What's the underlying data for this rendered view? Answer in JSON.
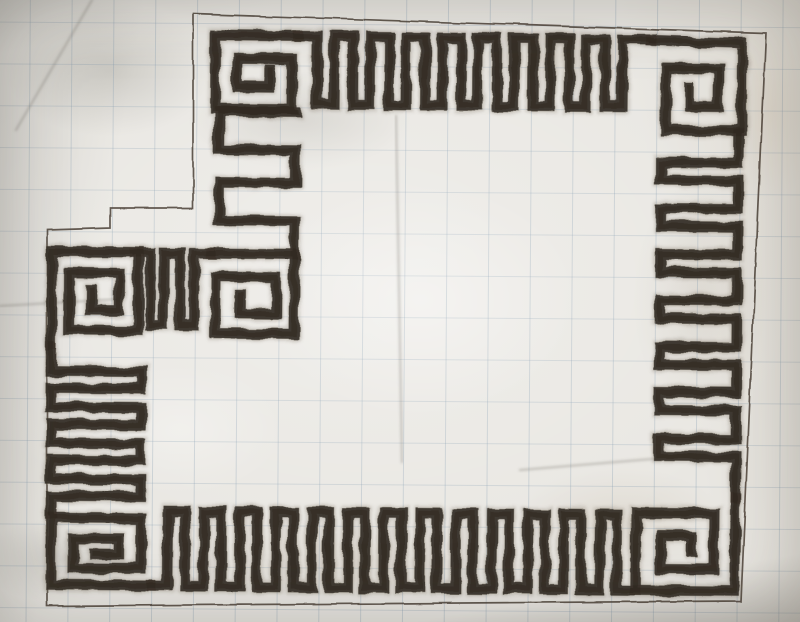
{
  "meta": {
    "description": "Hand-drawn Greek key meander border pattern sketched in dark charcoal pencil on wrinkled graph paper, inside a thin pencil outline with a stepped notch at the top-left; square spiral motifs at each corner."
  },
  "palette": {
    "paper": "#e9e7e2",
    "grid_line_v": "rgba(122,148,170,0.30)",
    "grid_line_h": "rgba(122,148,170,0.25)",
    "pencil_outline": "#4a4137",
    "charcoal_halo": "#77695a",
    "charcoal_main": "#3a332b",
    "charcoal_core": "#27211a",
    "crease": "rgba(110,106,98,0.35)"
  },
  "grid": {
    "cell": 41,
    "offset_x": 35,
    "offset_y": 30
  },
  "outline": {
    "width": 1.7,
    "points": [
      [
        193,
        14
      ],
      [
        766,
        33
      ],
      [
        741,
        601
      ],
      [
        47,
        606
      ],
      [
        47,
        230
      ],
      [
        110,
        228
      ],
      [
        110,
        208
      ],
      [
        193,
        208
      ]
    ],
    "closed": true
  },
  "pattern": {
    "rotation": "0.5 400 311",
    "halo_width": 14,
    "main_width": 10.5,
    "core_width": 5,
    "waves": [
      {
        "name": "meander-wave-top",
        "axis": "x",
        "dir": 1,
        "from": 296,
        "to": 648,
        "out": 37,
        "in": 105,
        "gap": 19,
        "tooth": 17
      },
      {
        "name": "meander-wave-right",
        "axis": "y",
        "dir": 1,
        "from": 132,
        "to": 494,
        "out": 737,
        "in": 660,
        "gap": 28,
        "tooth": 18
      },
      {
        "name": "meander-wave-bottom",
        "axis": "x",
        "dir": -1,
        "from": 638,
        "to": 154,
        "out": 588,
        "in": 513,
        "gap": 19,
        "tooth": 17
      },
      {
        "name": "meander-wave-left",
        "axis": "y",
        "dir": -1,
        "from": 518,
        "to": 350,
        "out": 52,
        "in": 142,
        "gap": 19,
        "tooth": 17
      },
      {
        "name": "meander-wave-notch",
        "axis": "x",
        "dir": 1,
        "from": 134,
        "to": 210,
        "out": 255,
        "in": 327,
        "gap": 16,
        "tooth": 14
      },
      {
        "name": "meander-wave-inner",
        "axis": "y",
        "dir": -1,
        "from": 255,
        "to": 112,
        "out": 294,
        "in": 218,
        "gap": 33,
        "tooth": 38
      }
    ],
    "spirals": [
      {
        "name": "corner-spiral-top-left",
        "points": [
          [
            296,
            37
          ],
          [
            213,
            37
          ],
          [
            213,
            110
          ],
          [
            290,
            110
          ],
          [
            290,
            60
          ],
          [
            235,
            60
          ],
          [
            235,
            88
          ],
          [
            268,
            88
          ],
          [
            268,
            71
          ]
        ]
      },
      {
        "name": "corner-spiral-top-right",
        "points": [
          [
            648,
            38
          ],
          [
            740,
            40
          ],
          [
            740,
            128
          ],
          [
            664,
            128
          ],
          [
            664,
            66
          ],
          [
            716,
            66
          ],
          [
            716,
            104
          ],
          [
            687,
            104
          ],
          [
            687,
            84
          ]
        ]
      },
      {
        "name": "corner-spiral-bottom-right",
        "points": [
          [
            737,
            494
          ],
          [
            737,
            588
          ],
          [
            638,
            588
          ],
          [
            638,
            511
          ],
          [
            716,
            511
          ],
          [
            716,
            567
          ],
          [
            663,
            567
          ],
          [
            663,
            533
          ],
          [
            694,
            533
          ],
          [
            694,
            549
          ]
        ]
      },
      {
        "name": "corner-spiral-bottom-left",
        "points": [
          [
            154,
            588
          ],
          [
            53,
            588
          ],
          [
            53,
            521
          ],
          [
            143,
            521
          ],
          [
            143,
            571
          ],
          [
            75,
            571
          ],
          [
            75,
            541
          ],
          [
            120,
            541
          ],
          [
            120,
            557
          ],
          [
            97,
            557
          ]
        ]
      },
      {
        "name": "terminal-spiral-left-top",
        "points": [
          [
            52,
            348
          ],
          [
            52,
            254
          ],
          [
            138,
            254
          ],
          [
            138,
            333
          ],
          [
            69,
            333
          ],
          [
            69,
            276
          ],
          [
            119,
            276
          ],
          [
            119,
            313
          ],
          [
            91,
            313
          ],
          [
            91,
            293
          ]
        ]
      },
      {
        "name": "spiral-notch-corner",
        "points": [
          [
            210,
            255
          ],
          [
            294,
            255
          ],
          [
            294,
            335
          ],
          [
            215,
            335
          ],
          [
            215,
            278
          ],
          [
            276,
            278
          ],
          [
            276,
            315
          ],
          [
            240,
            315
          ],
          [
            240,
            296
          ]
        ]
      }
    ]
  },
  "creases": [
    {
      "points": [
        [
          92,
          0
        ],
        [
          16,
          130
        ]
      ]
    },
    {
      "points": [
        [
          396,
          116
        ],
        [
          402,
          462
        ]
      ]
    },
    {
      "points": [
        [
          0,
          306
        ],
        [
          120,
          299
        ]
      ]
    },
    {
      "points": [
        [
          520,
          470
        ],
        [
          700,
          455
        ]
      ]
    }
  ],
  "stains": [
    {
      "x": 110,
      "y": 70,
      "rx": 150,
      "ry": 95,
      "color": "rgba(168,166,158,0.45)"
    },
    {
      "x": 300,
      "y": 120,
      "rx": 160,
      "ry": 70,
      "color": "rgba(173,170,162,0.35)"
    },
    {
      "x": 560,
      "y": 55,
      "rx": 120,
      "ry": 60,
      "color": "rgba(202,192,176,0.32)"
    },
    {
      "x": 420,
      "y": 300,
      "rx": 230,
      "ry": 170,
      "color": "rgba(255,255,255,0.35)"
    },
    {
      "x": 180,
      "y": 430,
      "rx": 150,
      "ry": 95,
      "color": "rgba(255,255,255,0.30)"
    },
    {
      "x": 700,
      "y": 300,
      "rx": 95,
      "ry": 170,
      "color": "rgba(190,182,170,0.30)"
    },
    {
      "x": 620,
      "y": 520,
      "rx": 150,
      "ry": 75,
      "color": "rgba(205,195,180,0.35)"
    },
    {
      "x": 60,
      "y": 560,
      "rx": 120,
      "ry": 60,
      "color": "rgba(152,150,142,0.30)"
    },
    {
      "x": 770,
      "y": 110,
      "rx": 70,
      "ry": 130,
      "color": "rgba(216,206,190,0.40)"
    },
    {
      "x": 360,
      "y": 560,
      "rx": 200,
      "ry": 55,
      "color": "rgba(214,206,192,0.30)"
    }
  ]
}
